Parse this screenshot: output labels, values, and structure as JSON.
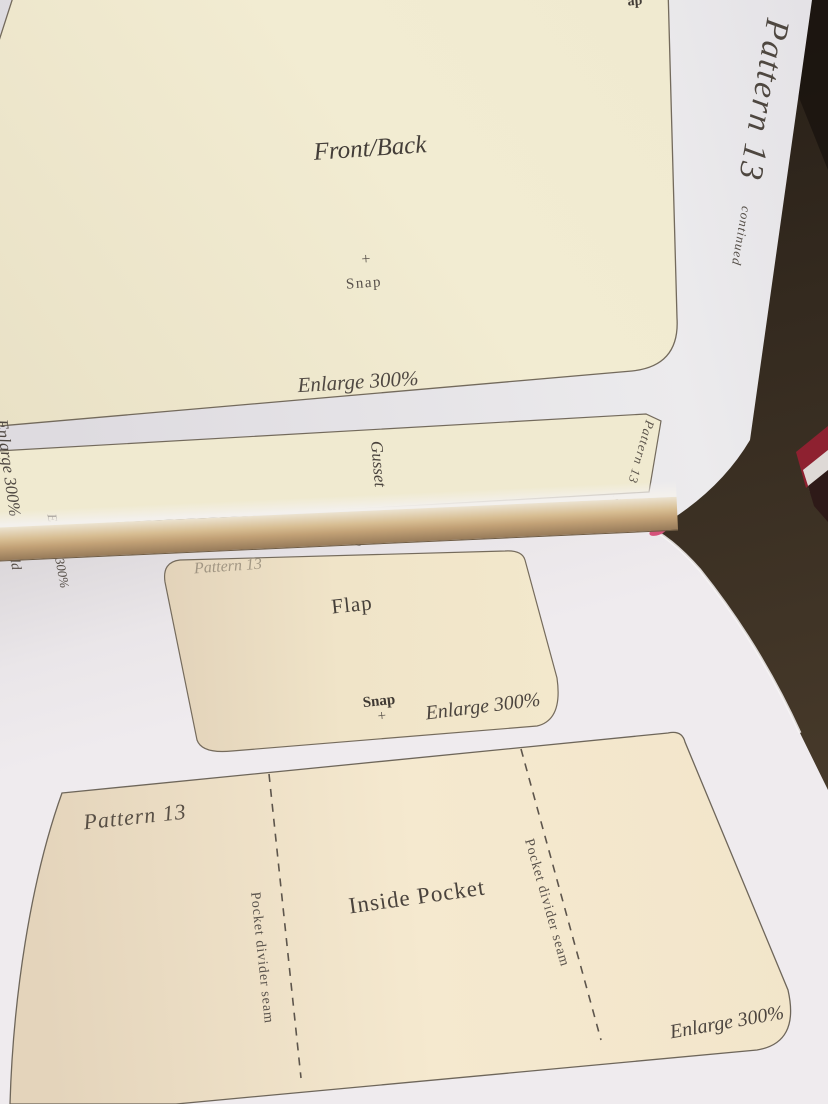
{
  "page_header": {
    "title": "Pattern 13",
    "subtitle": "continued"
  },
  "top_page": {
    "front_back": {
      "name": "Front/Back",
      "snap_plus": "+",
      "snap": "Snap",
      "enlarge": "Enlarge 300%",
      "edge_fragment": "ap"
    },
    "gusset": {
      "name": "Gusset",
      "enlarge": "Enlarge 300%",
      "corner": "Pattern 13"
    },
    "strap": {
      "name": "Strap",
      "fold": "Fold",
      "enlarge": "Enlarge 300%",
      "corner": "Pattern"
    }
  },
  "bottom_page": {
    "flap": {
      "corner": "Pattern 13",
      "name": "Flap",
      "snap": "Snap",
      "snap_plus": "+",
      "enlarge": "Enlarge 300%"
    },
    "inside_pocket": {
      "corner": "Pattern 13",
      "name": "Inside Pocket",
      "seam_left": "Pocket divider seam",
      "seam_right": "Pocket divider seam",
      "enlarge": "Enlarge 300%"
    }
  },
  "colors": {
    "carpet_brown": "#352a1f",
    "page_white": "#e9e6e8",
    "bottom_page_white": "#ece8eb",
    "piece_cream": "#f1ebd0",
    "flap_cream": "#f0e3c9",
    "pocket_cream": "#f3e7cd",
    "ink": "#4c453f",
    "outline": "#716859",
    "spine_tan": "#c2a176",
    "red_object": "#8e2130",
    "pink_sliver": "#d6527b"
  }
}
